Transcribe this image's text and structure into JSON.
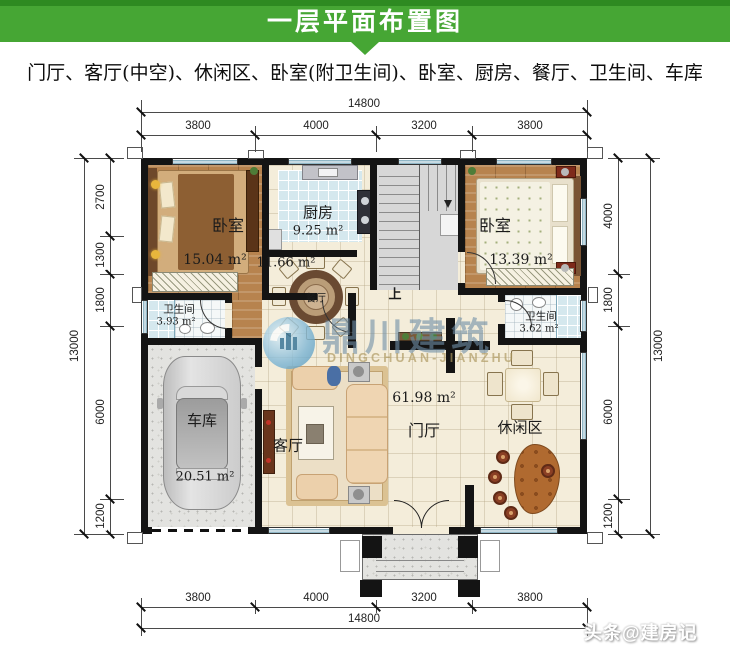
{
  "header": {
    "title": "一层平面布置图"
  },
  "subtitle": "门厅、客厅(中空)、休闲区、卧室(附卫生间)、卧室、厨房、餐厅、卫生间、车库",
  "watermark": {
    "cn": "鼎川建筑",
    "en": "DINGCHUAN-JIANZHU"
  },
  "credit": "头条@建房记",
  "colors": {
    "header_green": "#46a634",
    "wall": "#141414",
    "floor_cream": "#f4edda",
    "wood": "#b7834e",
    "tile_blue": "#d5e8ee",
    "garage_grey": "#e3e3e0",
    "watermark_blue": "#6e8ea6",
    "watermark_gold": "#ac9860"
  },
  "dims": {
    "top": {
      "total": "14800",
      "segments": [
        "3800",
        "4000",
        "3200",
        "3800"
      ]
    },
    "bottom": {
      "total": "14800",
      "segments": [
        "3800",
        "4000",
        "3200",
        "3800"
      ]
    },
    "left": {
      "total": "13000",
      "segments": [
        "2700",
        "1300",
        "1800",
        "6000",
        "1200"
      ]
    },
    "right": {
      "total": "13000",
      "segments": [
        "4000",
        "1800",
        "6000",
        "1200"
      ]
    }
  },
  "rooms": {
    "bedroom_left": {
      "name": "卧室",
      "area": "15.04 m²"
    },
    "kitchen": {
      "name": "厨房",
      "area": "9.25 m²"
    },
    "dining": {
      "name": "餐厅",
      "area": "11.66 m²"
    },
    "bedroom_right": {
      "name": "卧室",
      "area": "13.39 m²"
    },
    "bath_left": {
      "name": "卫生间",
      "area": "3.93 m²"
    },
    "bath_right": {
      "name": "卫生间",
      "area": "3.62 m²"
    },
    "garage": {
      "name": "车库",
      "area": "20.51 m²"
    },
    "hall": {
      "name": "门厅",
      "area": "61.98 m²"
    },
    "living": {
      "name": "客厅"
    },
    "leisure": {
      "name": "休闲区"
    },
    "stairs": {
      "up": "上"
    }
  }
}
